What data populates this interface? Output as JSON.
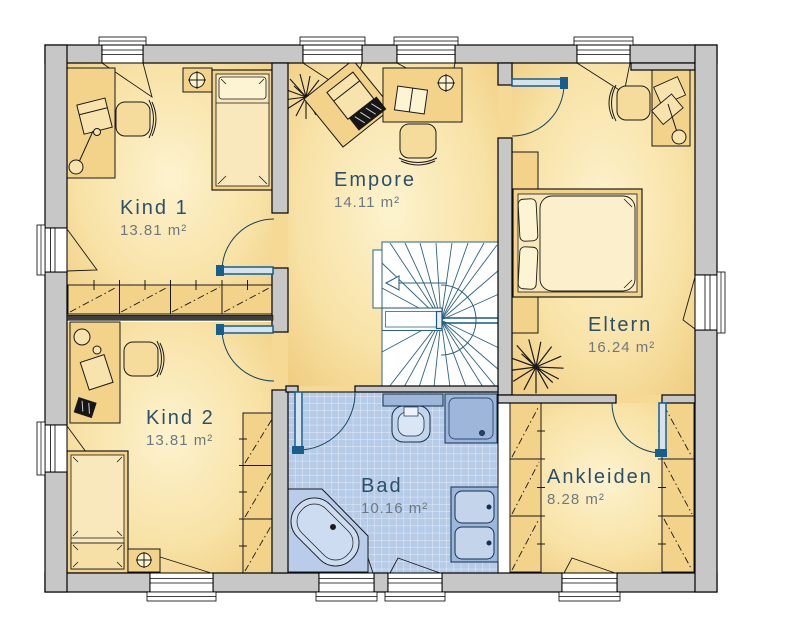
{
  "plan": {
    "rooms": [
      {
        "name": "Kind 1",
        "area": "13.81 m²"
      },
      {
        "name": "Empore",
        "area": "14.11 m²"
      },
      {
        "name": "Eltern",
        "area": "16.24 m²"
      },
      {
        "name": "Kind 2",
        "area": "13.81 m²"
      },
      {
        "name": "Bad",
        "area": "10.16 m²"
      },
      {
        "name": "Ankleiden",
        "area": "8.28 m²"
      }
    ],
    "colors": {
      "wall_fill": "#c7c7c7",
      "wall_stroke": "#000000",
      "floor_center": "#fdf3cf",
      "floor_edge": "#eec878",
      "tile": "#b6cbe7",
      "tile_line": "#e9effa",
      "fixture": "#9db6da",
      "fixture_light": "#c3d4eb",
      "door_blue": "#155e8e",
      "stair_line": "#2e6480",
      "room_name_color": "#2b5069",
      "room_area_color": "#6d7982"
    },
    "symbols": [
      "bed",
      "desk",
      "office-chair",
      "wardrobe",
      "plant",
      "winder-staircase",
      "corner-bathtub",
      "shower",
      "toilet",
      "double-washbasin",
      "ceiling-lamp",
      "desk-lamp",
      "window",
      "door"
    ]
  }
}
